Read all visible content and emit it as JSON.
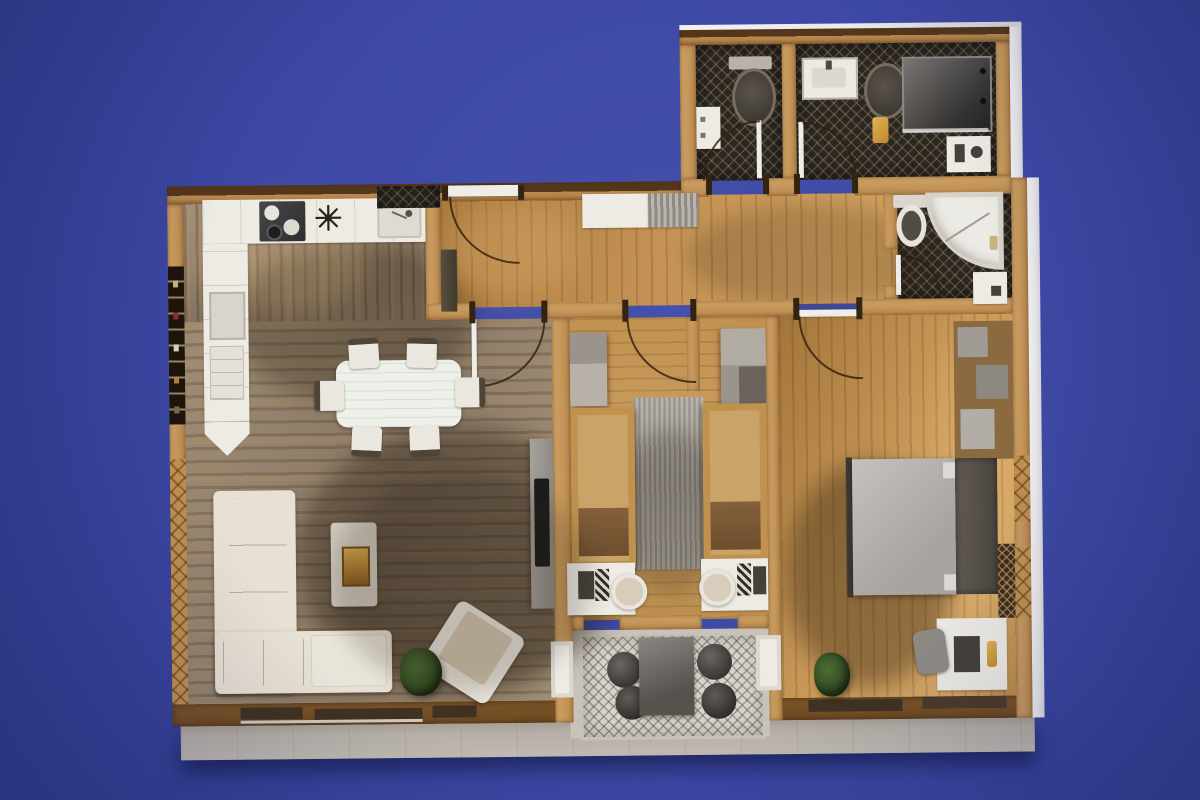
{
  "canvas": {
    "width": 1200,
    "height": 800,
    "scene_type": "photo of a 3D-rendered apartment floor-plan model on an indigo studio backdrop",
    "view": "top-down"
  },
  "palette": {
    "backdrop": "#3d49a5",
    "backdrop_dark": "#323d92",
    "backdrop_light": "#4350ac",
    "wall": "#b9894e",
    "wall_light": "#d2a466",
    "wall_dark": "#54361a",
    "wall_brown": "#6e4a22",
    "cut_edge": "#e9e8ea",
    "wood_warm": "#c59355",
    "wood_grey": "#94826c",
    "tile_dark": "#2b2620",
    "rug_kids": "#b2ada6",
    "rug_loggia": "#d8d4cc",
    "balcony": "#b5afa7",
    "furn_white": "#edebe4",
    "furn_beige": "#d3c6b2",
    "furn_grey": "#b0adaa",
    "furn_dark": "#44403a",
    "arc": "rgba(46,30,12,0.8)",
    "gold": "#c08a2e",
    "plant": "#3a5527",
    "window_dark": "#3f3222"
  },
  "rooms": [
    {
      "name": "kitchen",
      "floor": "grey-washed wood planks"
    },
    {
      "name": "living-dining",
      "floor": "grey-washed wood planks"
    },
    {
      "name": "entry-hall",
      "floor": "warm oak planks"
    },
    {
      "name": "kids-bedroom",
      "floor": "warm oak planks with grey rug"
    },
    {
      "name": "master-bedroom",
      "floor": "warm oak planks"
    },
    {
      "name": "bathroom-wc-left",
      "floor": "dark patterned tile"
    },
    {
      "name": "bathroom-shower-right",
      "floor": "dark patterned tile"
    },
    {
      "name": "bathroom-ensuite",
      "floor": "dark patterned tile"
    },
    {
      "name": "loggia-patio",
      "floor": "diamond patterned rug"
    },
    {
      "name": "balcony-terrace",
      "floor": "light grey decking"
    }
  ],
  "furniture": {
    "kitchen": [
      "L-shaped white counter",
      "cooktop with pots",
      "star wall clock",
      "sink",
      "tall cabinet column",
      "entry mat"
    ],
    "entry_hall": [
      "white entrance door with swing arc",
      "white sideboard",
      "slatted bench",
      "dark tall cabinet"
    ],
    "living_dining": [
      "white dining table",
      "six white chairs",
      "L-shaped beige sofa",
      "white ottoman",
      "coffee table with amber tray",
      "rotated armchair",
      "potted plant",
      "TV sideboard with flatscreen"
    ],
    "kids_bedroom": [
      "two grey wardrobes",
      "two single beds with brown throws",
      "grey rug",
      "two white desks with laptops",
      "two desk chairs",
      "privacy stub wall"
    ],
    "master_bedroom": [
      "double bed grey linen",
      "dark headboard wardrobe",
      "shelving column with grey boxes",
      "lattice shelf",
      "white desk with laptop and gold lamp",
      "grey desk chair",
      "potted plant"
    ],
    "bathroom_wc_left": [
      "toilet",
      "wall cabinet",
      "door with swing arc"
    ],
    "bathroom_shower_right": [
      "vanity sink",
      "toilet",
      "gold pedal bin",
      "walk-in shower",
      "white mat with accessories",
      "door with swing arc"
    ],
    "bathroom_ensuite": [
      "toilet with cistern",
      "quarter-round corner shower",
      "low cabinet",
      "door with swing arc"
    ],
    "loggia_patio": [
      "dark bistro table",
      "four dark round chairs",
      "two white planters"
    ],
    "balcony_terrace": [
      "window wall with dark glazing bands"
    ]
  }
}
